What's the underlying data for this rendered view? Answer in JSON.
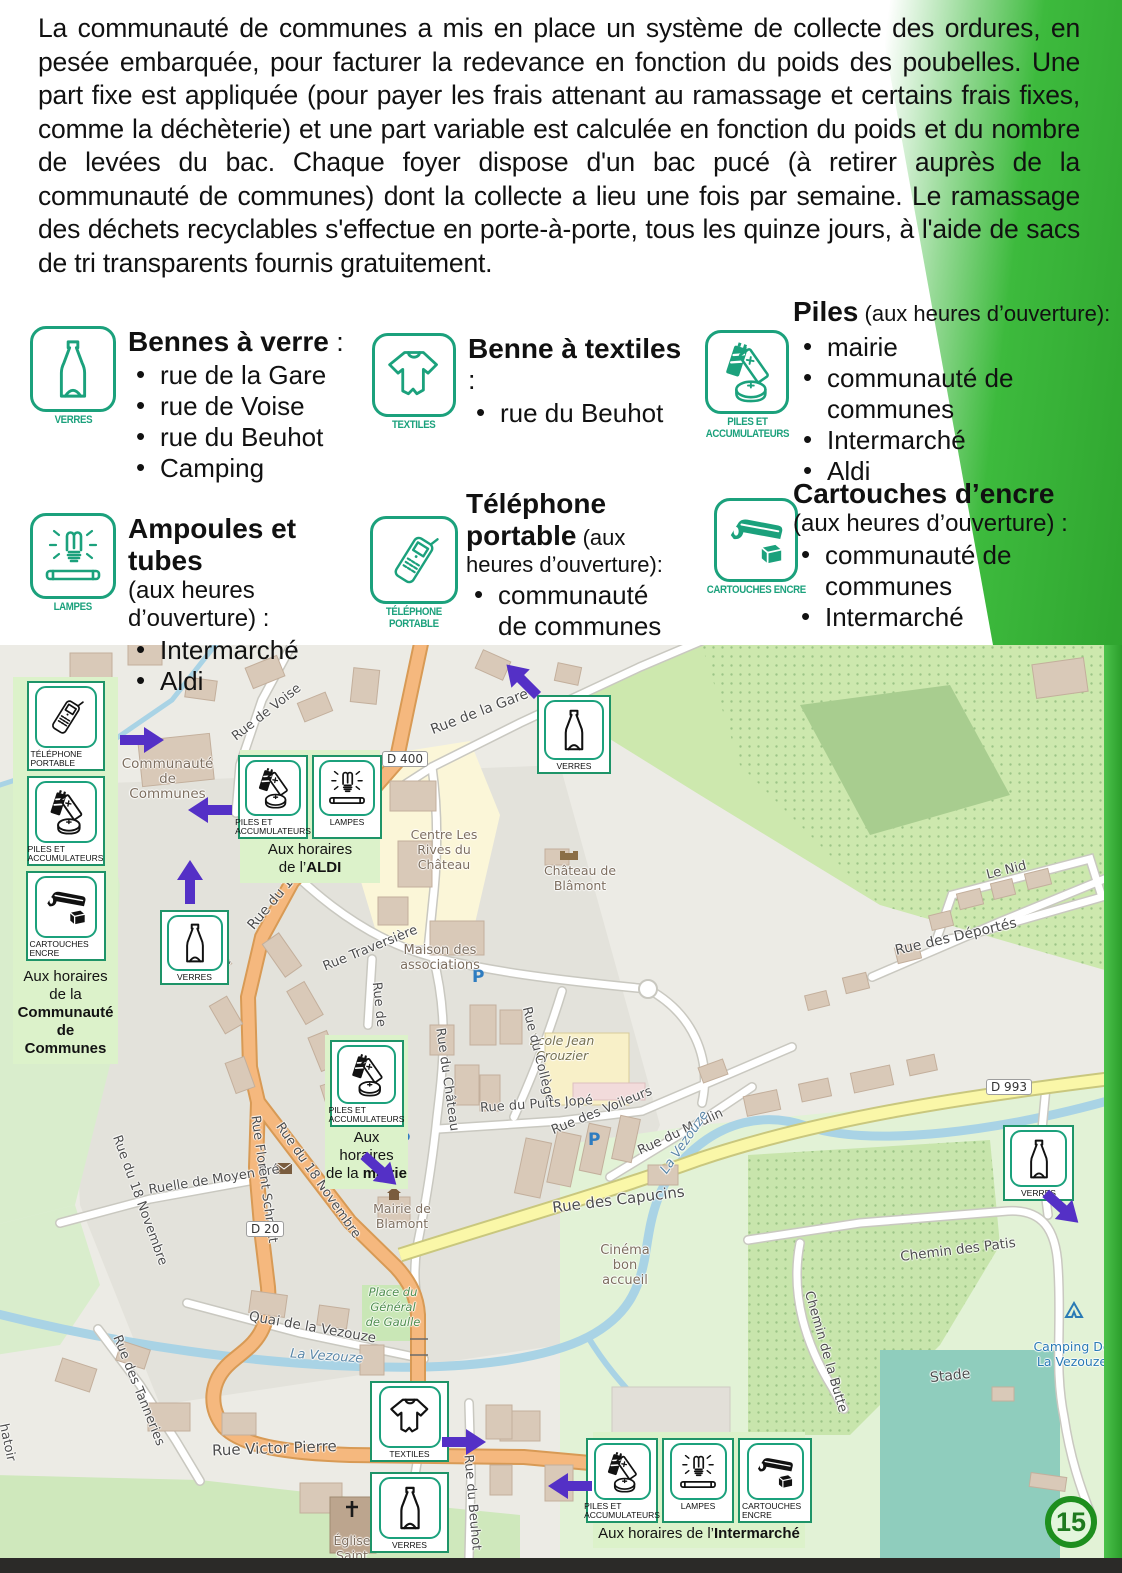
{
  "page": {
    "number": "15"
  },
  "colors": {
    "accent_green": "#3DBA3D",
    "icon_teal": "#1BA17C",
    "arrow_purple": "#5430C6",
    "callout_bg": "#DCF2CA"
  },
  "intro": {
    "text": "La communauté de communes a mis en place un système de collecte des ordures, en pesée embarquée, pour facturer la redevance en fonction du poids des poubelles. Une part fixe est appliquée (pour payer les frais attenant au ramassage et certains frais fixes, comme la déchèterie) et une part variable est calculée en fonction du poids et du nombre de levées du bac. Chaque foyer dispose d'un bac pucé (à retirer auprès de la communauté de communes) dont la collecte a lieu une fois par semaine. Le ramassage des déchets recyclables s'effectue en porte-à-porte, tous les quinze jours, à l'aide de sacs de tri transparents fournis gratuitement."
  },
  "icons": {
    "verres": "VERRES",
    "textiles": "TEXTILES",
    "piles": "PILES ET\nACCUMULATEURS",
    "lampes": "LAMPES",
    "telephone": "TÉLÉPHONE\nPORTABLE",
    "cartouches": "CARTOUCHES ENCRE"
  },
  "sections": {
    "verre": {
      "title": "Bennes à verre",
      "sep": " :",
      "items": [
        "rue de la Gare",
        "rue de Voise",
        "rue du Beuhot",
        "Camping"
      ]
    },
    "textiles": {
      "title": "Benne à textiles",
      "sep": " :",
      "items": [
        "rue du Beuhot"
      ]
    },
    "piles": {
      "title": "Piles",
      "suffix": " (aux heures d’ouverture):",
      "items": [
        "mairie",
        "communauté de communes",
        "Intermarché",
        "Aldi"
      ]
    },
    "ampoules": {
      "title": "Ampoules et tubes",
      "suffix": "(aux heures d’ouverture) :",
      "items": [
        "Intermarché",
        "Aldi"
      ]
    },
    "telephone": {
      "title": "Téléphone portable",
      "suffix": " (aux heures d’ouverture):",
      "items": [
        "communauté de communes"
      ]
    },
    "cartouches": {
      "title": "Cartouches d’encre",
      "suffix": "(aux heures d’ouverture) :",
      "items": [
        "communauté de communes",
        "Intermarché"
      ]
    }
  },
  "map": {
    "labels": {
      "rue_de_voise": "Rue de Voise",
      "voise_frag": "ise",
      "rue_de_frag": "Rue de",
      "rue_de_la_gare": "Rue de la Gare",
      "d400": "D 400",
      "rue_18nov_top": "Rue du 18 Novembre",
      "rue_18nov_left": "Rue du 18 Novembre",
      "rue_18nov_right": "Rue du 18 Novembre",
      "rue_traversiere": "Rue Traversière",
      "maison_assoc": "Maison des associations",
      "communaute": "Communauté de Communes",
      "centre_rives": "Centre Les Rives du Château",
      "chateau": "Château de Blâmont",
      "ecole": "École Jean Crouzier",
      "rue_du_college": "Rue du Collège",
      "rue_du_chateau": "Rue du Château",
      "puits_jope": "Rue du Puits Jopé",
      "voileurs": "Rue des Voileurs",
      "moulin": "Rue du Moulin",
      "vezouze1": "La Vezouze",
      "vezouze2": "La Vezouze",
      "capucins": "Rue des Capucins",
      "d993": "D 993",
      "deportes": "Rue des Déportés",
      "le_nid": "Le Nid",
      "cinema": "Cinéma bon accueil",
      "moyen_pre": "Ruelle de Moyen Pré",
      "florent": "Rue Florent Schmitt",
      "d20": "D 20",
      "quai": "Quai de la Vezouze",
      "tanneries": "Rue des Tanneries",
      "victor": "Rue Victor Pierre",
      "beuhot": "Rue du Beuhot",
      "patis": "Chemin des Patis",
      "butte": "Chemin de la Butte",
      "stade": "Stade",
      "camping": "Camping De La Vezouze",
      "place_gaulle": "Place du Général de Gaulle",
      "eglise": "Église Saint Maurice",
      "mairie": "Mairie de Blamont",
      "abattoir_frag": "hatoir"
    },
    "callouts": {
      "cdc": {
        "line1": "Aux horaires de la",
        "bold1": "Communauté de",
        "bold2": "Communes"
      },
      "aldi": {
        "line1": "Aux horaires",
        "line2_prefix": "de l’",
        "line2_bold": "ALDI"
      },
      "mairie": {
        "line1": "Aux horaires",
        "line2_prefix": "de la ",
        "line2_bold": "mairie"
      },
      "intermarche": {
        "prefix": "Aux horaires de l’",
        "bold": "Intermarché"
      }
    }
  }
}
